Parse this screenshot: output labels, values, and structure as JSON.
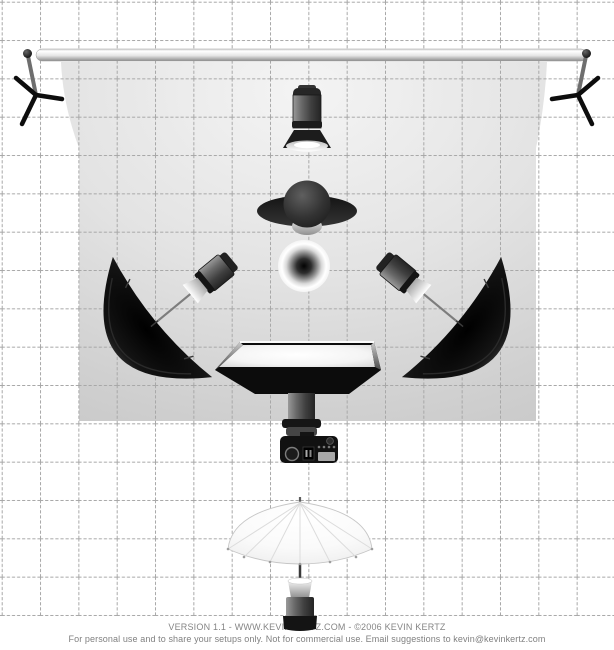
{
  "diagram": {
    "name": "Studio lighting setup diagram (top view)",
    "credits_line1": "VERSION 1.1   -   WWW.KEVINKERTZ.COM   -   ©2006 KEVIN KERTZ",
    "credits_line2": "For personal use and to share your setups only. Not for commercial use.  Email suggestions to kevin@kevinkertz.com"
  },
  "grid": {
    "cell_px": 38.33,
    "cols": 16,
    "rows": 16,
    "line_color": "#a8a8a8",
    "style": "dashed"
  },
  "equipment": [
    {
      "id": "backdrop-stand-left",
      "label": "Backdrop stand, left (top view tripod)"
    },
    {
      "id": "backdrop-crossbar",
      "label": "Backdrop crossbar / pole"
    },
    {
      "id": "backdrop-stand-right",
      "label": "Backdrop stand, right (top view tripod)"
    },
    {
      "id": "seamless-backdrop",
      "label": "Gray seamless backdrop"
    },
    {
      "id": "background-light",
      "label": "Background strobe with reflector, aimed at backdrop"
    },
    {
      "id": "subject-person",
      "label": "Subject person, top view (head and shoulders)"
    },
    {
      "id": "subject-sphere",
      "label": "Sphere subject / light orb"
    },
    {
      "id": "umbrella-light-left",
      "label": "Strobe into black reflective umbrella, camera-left at 45°"
    },
    {
      "id": "umbrella-light-right",
      "label": "Strobe into black reflective umbrella, camera-right at 45°"
    },
    {
      "id": "overhead-softbox",
      "label": "Softbox mounted above lens axis"
    },
    {
      "id": "camera",
      "label": "Camera, top view, lens toward subject"
    },
    {
      "id": "shoot-through-umbrella-light",
      "label": "Strobe with white shoot-through umbrella behind camera"
    }
  ],
  "colors": {
    "canvas": "#ffffff",
    "grid_line": "#a8a8a8",
    "backdrop_light": "#f4f4f4",
    "backdrop_dark": "#c7c7c7",
    "equipment_dark": "#111111",
    "umbrella_black": "#0d0d0d",
    "umbrella_white": "#fafafa",
    "credits_text": "#858585"
  }
}
